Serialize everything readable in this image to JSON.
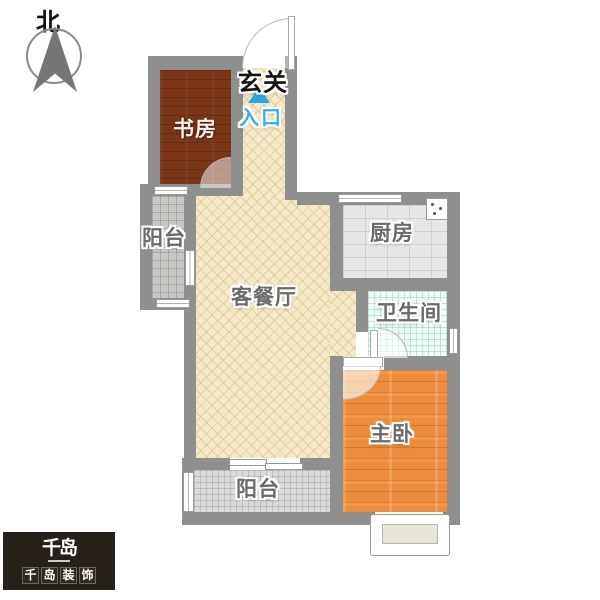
{
  "compass": {
    "label": "北"
  },
  "entrance": {
    "hall_label": "玄关",
    "entry_label": "入口"
  },
  "rooms": {
    "study": {
      "label": "书房"
    },
    "living_dining": {
      "label": "客餐厅"
    },
    "kitchen": {
      "label": "厨房"
    },
    "bathroom": {
      "label": "卫生间"
    },
    "master_bedroom": {
      "label": "主卧"
    },
    "balcony_left": {
      "label": "阳台"
    },
    "balcony_bottom": {
      "label": "阳台"
    }
  },
  "logo": {
    "mark": "千岛",
    "name": "千岛装饰",
    "chars": [
      "千",
      "岛",
      "装",
      "饰"
    ]
  },
  "colors": {
    "wall": "#8f8f8f",
    "study_floor": "#7b3517",
    "living_floor": "#f6e9c8",
    "kitchen_floor": "#e7e7e9",
    "bathroom_floor": "#f1fbf8",
    "bedroom_floor": "#ec8c3c",
    "balcony_left_floor": "#cac8c5",
    "balcony_bottom_floor": "#dbdbdb",
    "entry_accent": "#2aa8dc",
    "logo_bg": "#262019"
  }
}
